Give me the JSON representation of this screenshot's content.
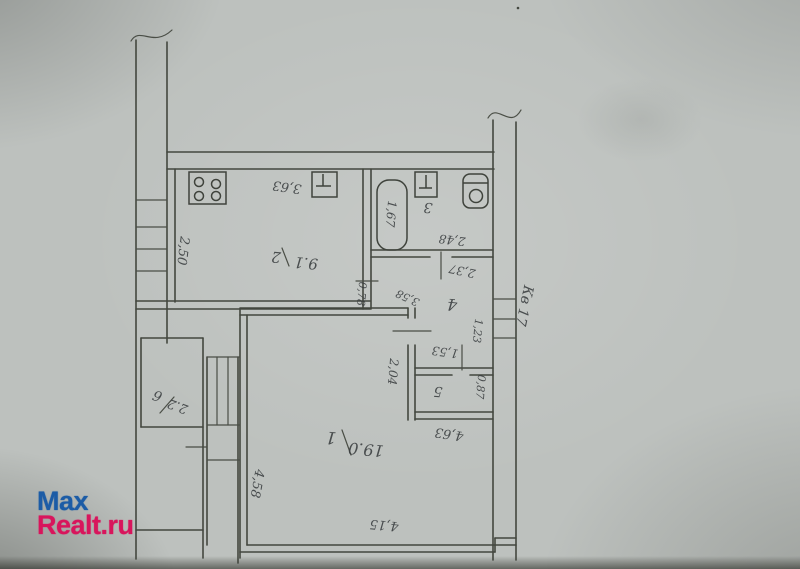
{
  "photo": {
    "paper_color": "#bdc1be",
    "ink_color": "#43473f",
    "description": "photographed hand-drawn BTI floor plan, drawing appears rotated 180 degrees"
  },
  "watermark": {
    "line1": "Max",
    "line2": "Realt.ru",
    "color_line1": "#1c5ca6",
    "color_line2": "#d8155c"
  },
  "plan": {
    "apartment_note": "Кв 17",
    "rooms": {
      "room1": {
        "number": "1",
        "area": "19.0"
      },
      "room2": {
        "number": "2",
        "area": "9.1"
      },
      "room3": {
        "number": "3"
      },
      "room4": {
        "number": "4"
      },
      "room5": {
        "number": "5"
      },
      "room6": {
        "number": "6",
        "area": "2.2"
      }
    },
    "dims": {
      "kitchen_width": "3,63",
      "kitchen_depth": "2,50",
      "bathtub_length": "1,67",
      "bath_width": "2,48",
      "hall_length": "2,37",
      "hall_diagonal": "3,58",
      "hall_opening": "0,78",
      "hall_side": "1,23",
      "closet_width": "1,53",
      "closet_depth": "0,87",
      "room1_inner_width": "4,63",
      "room1_depth": "4,58",
      "room1_side": "2,04",
      "room1_width": "4,15"
    },
    "icons": {
      "stove": "square-with-4-burner-circles",
      "kitchen_sink": "box-with-T-mark",
      "washbasin": "box-with-T-mark",
      "bathtub": "rounded-rectangle",
      "toilet": "rounded-box-with-circle"
    }
  }
}
